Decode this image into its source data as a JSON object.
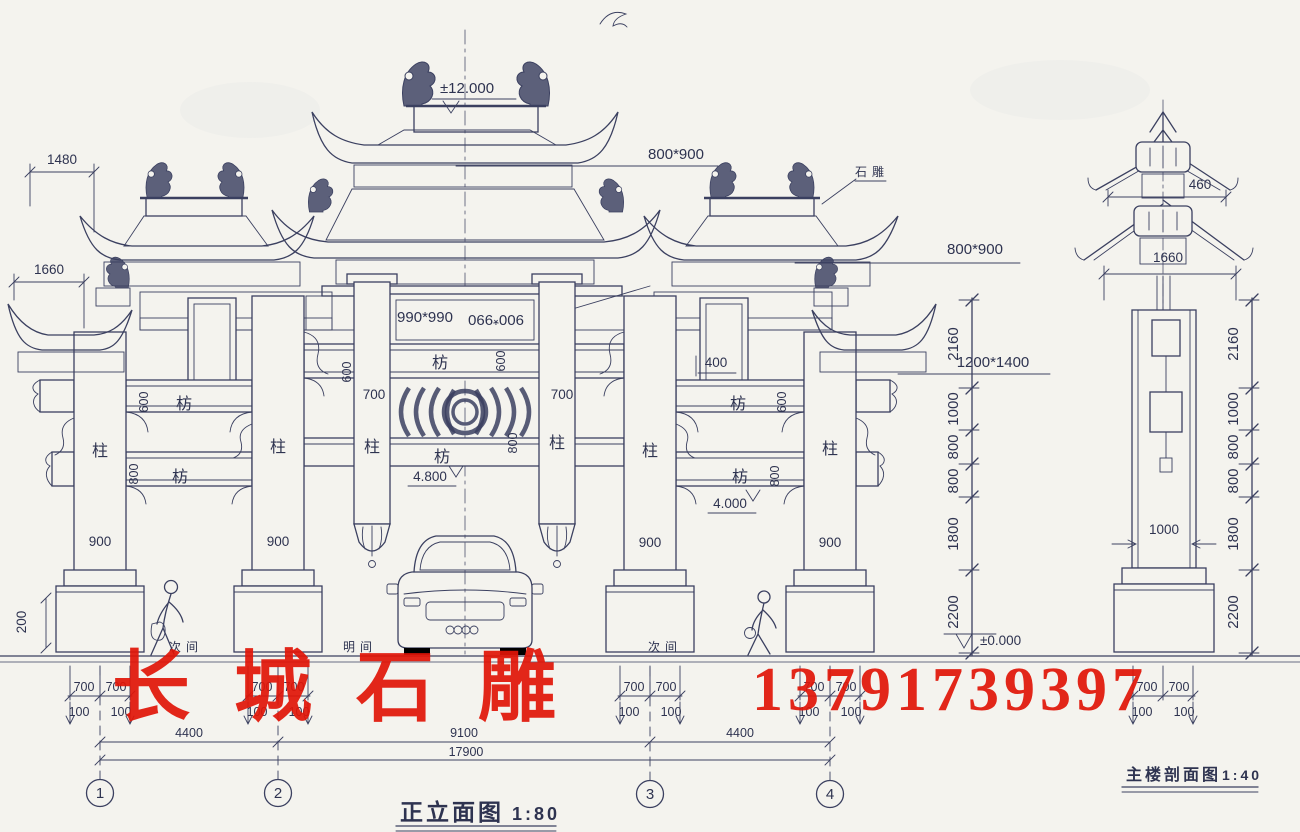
{
  "colors": {
    "ink": "#3b4060",
    "paper": "#f4f3ee",
    "watermark_red": "#e11508"
  },
  "watermark": {
    "brand": "长城石雕",
    "phone": "13791739397"
  },
  "titles": {
    "front_name": "正立面图",
    "front_scale": "1:80",
    "section_name": "主楼剖面图",
    "section_scale": "1:40"
  },
  "axes": {
    "a1": "1",
    "a2": "2",
    "a3": "3",
    "a4": "4"
  },
  "bays": {
    "left": "次间",
    "center": "明间",
    "right": "次间"
  },
  "members": {
    "column": "柱",
    "beam": "枋"
  },
  "levels": {
    "top": "±12.000",
    "ground": "±0.000"
  },
  "annotations": {
    "ornament_note": "石雕",
    "roof_beam_top": "800*900",
    "roof_beam_side": "800*900",
    "plaque_a": "990*990",
    "plaque_b": "900*990",
    "main_plaque": "1200*1400",
    "panel_400": "400",
    "beam_700_l": "700",
    "beam_700_r": "700",
    "clear_center": "4.800",
    "clear_side": "4.000",
    "col_900": "900",
    "plinth_200": "200",
    "eave_1480": "1480",
    "eave_1660": "1660",
    "dim_600": "600",
    "dim_800": "800"
  },
  "height_chain": {
    "seg1": "2160",
    "seg2": "1000",
    "seg3": "800",
    "seg4": "800",
    "seg5": "1800",
    "seg6": "2200"
  },
  "section": {
    "dim_460": "460",
    "dim_1660": "1660",
    "col_width": "1000"
  },
  "footing": {
    "d700": "700",
    "d100": "100"
  },
  "spans": {
    "side_l": "4400",
    "center": "9100",
    "side_r": "4400",
    "total": "17900"
  }
}
